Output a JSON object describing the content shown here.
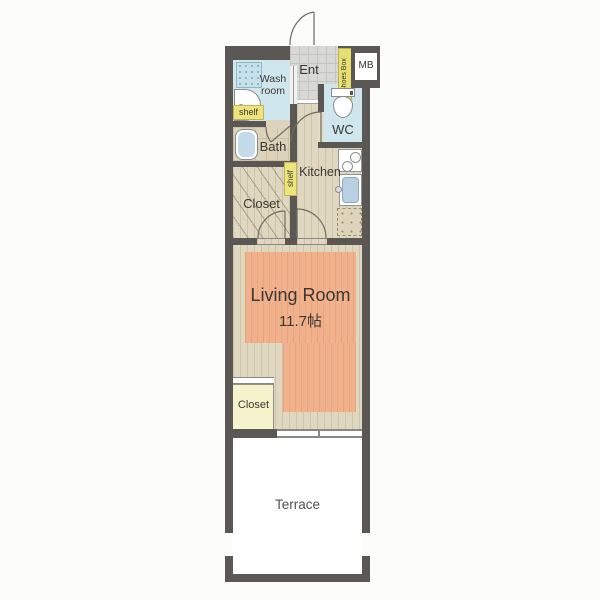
{
  "plan": {
    "entrance": {
      "label": "Ent"
    },
    "shoes_box": {
      "label": "Shoes Box"
    },
    "meter_box": {
      "label": "MB"
    },
    "washroom": {
      "label": "Wash room",
      "shelf": "shelf"
    },
    "bath": {
      "label": "Bath"
    },
    "wc": {
      "label": "WC"
    },
    "kitchen": {
      "label": "Kitchen",
      "shelf": "shelf"
    },
    "closet_upper": {
      "label": "Closet"
    },
    "living_room": {
      "label": "Living Room",
      "area": "11.7帖"
    },
    "closet_lower": {
      "label": "Closet"
    },
    "terrace": {
      "label": "Terrace"
    },
    "colors": {
      "wall": "#5b5754",
      "water_blue": "#cfe7ec",
      "wood_floor": "#e0d7c0",
      "carpet": "#f1b18c",
      "closet_yellow": "#f6f2cc",
      "shelf_yellow": "#eee47c",
      "entry_tile": "#d8d8d6"
    }
  }
}
